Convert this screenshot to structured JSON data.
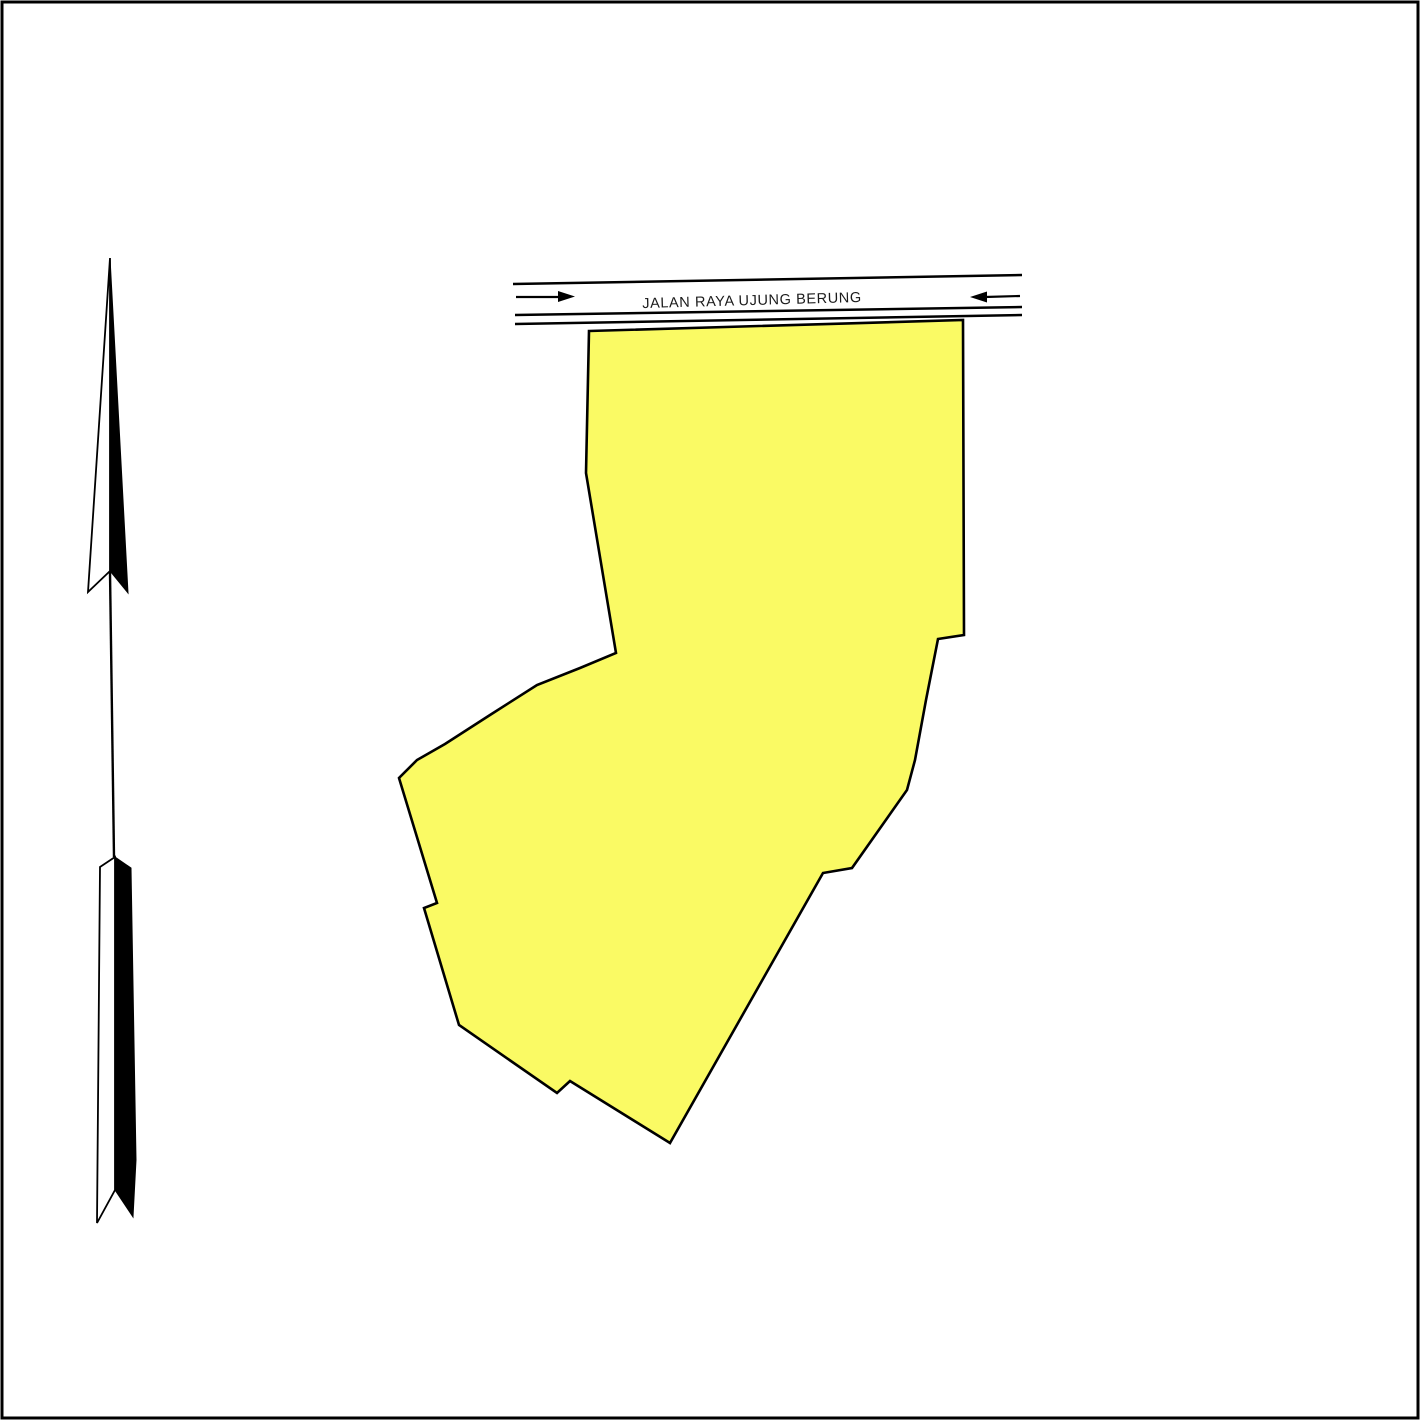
{
  "page": {
    "title": "Site plan map",
    "background": "#ffffff",
    "border_color": "#000000"
  },
  "road": {
    "label": "JALAN RAYA UJUNG BERUNG",
    "label_color": "#1a1a1a",
    "line_color": "#000000",
    "top_line_points": "513,284 1022,275",
    "bottom_line1_points": "515,315 1022,307",
    "bottom_line2_points": "515,324 1022,315",
    "arrow_right_shaft_points": "516,297 559,297",
    "arrow_right_head_points": "558,291 575,296.5 558,302",
    "arrow_left_shaft_points": "985,297 1020,296",
    "arrow_left_head_points": "987,291.5 970,297 987,302.5"
  },
  "parcel": {
    "label": "land parcel",
    "fill": "#FAFA64",
    "stroke": "#000000",
    "points": "589,331 963,320 964,635 938,639 926,700 915,760 907,790 852,868 823,873 670,1143 570,1081 557,1093 459,1025 424,908 437,903 399,778 417,760 445,744 490,715 537,685 580,668 616,653 586,473"
  },
  "north_arrow": {
    "label": "north arrow",
    "dark": "#000000",
    "light": "#ffffff",
    "head_light_points": "110,258 110,571 88,592",
    "head_dark_points": "110,258 128,593 110,571",
    "shaft_points": "110,572 114,857",
    "tail_light_points": "115,857 100,867 97,1223 115,1190",
    "tail_dark_points": "115,857 131,868 136,1160 133,1217 115,1190"
  }
}
